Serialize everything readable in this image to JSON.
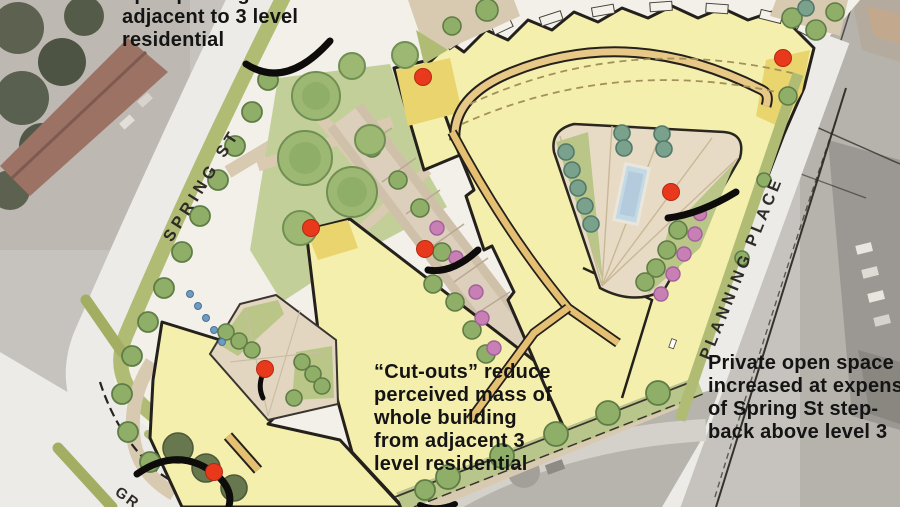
{
  "annotations": {
    "top_left": {
      "lines": [
        "open parking",
        "adjacent to 3 level",
        "residential"
      ]
    },
    "center": {
      "lines": [
        "“Cut-outs” reduce",
        "perceived mass of",
        "whole building",
        "from adjacent 3",
        "level residential"
      ]
    },
    "right": {
      "lines": [
        "Private open space",
        "increased at expense",
        "of Spring St step-",
        "back above level 3"
      ]
    }
  },
  "street_labels": {
    "spring": "SPRING ST",
    "planning": "PLANNING PLACE",
    "partial_bottom_left": "GR"
  },
  "markers": {
    "dot_color": "#e8391d",
    "dot_edge_color": "#b32a12",
    "arrow_color": "#0d0c0a",
    "dots": [
      {
        "x": 423,
        "y": 77
      },
      {
        "x": 783,
        "y": 58
      },
      {
        "x": 311,
        "y": 228
      },
      {
        "x": 425,
        "y": 249
      },
      {
        "x": 671,
        "y": 192
      },
      {
        "x": 265,
        "y": 369
      },
      {
        "x": 214,
        "y": 472
      }
    ],
    "arrows": [
      {
        "d": "M 246,64 Q 286,90 330,41",
        "w": 7
      },
      {
        "d": "M 428,270 Q 452,274 478,250",
        "w": 7
      },
      {
        "d": "M 262,376 Q 258,388 263,398",
        "w": 5
      },
      {
        "d": "M 668,218 Q 700,214 736,192",
        "w": 7
      },
      {
        "d": "M 137,474 Q 180,444 219,477 Q 233,491 229,506",
        "w": 7
      },
      {
        "d": "M 420,505 Q 437,512 455,504",
        "w": 6
      }
    ]
  },
  "legend_colors": {
    "building": "#f5efad",
    "building_dark": "#e9d46e",
    "courtyard_paving": "#e7dbc6",
    "greenery": "#b9c68b",
    "tree": "#8fae68",
    "pink_shrub": "#c77fb4",
    "pool": "#c4d9e6",
    "street": "#ecebe7"
  }
}
